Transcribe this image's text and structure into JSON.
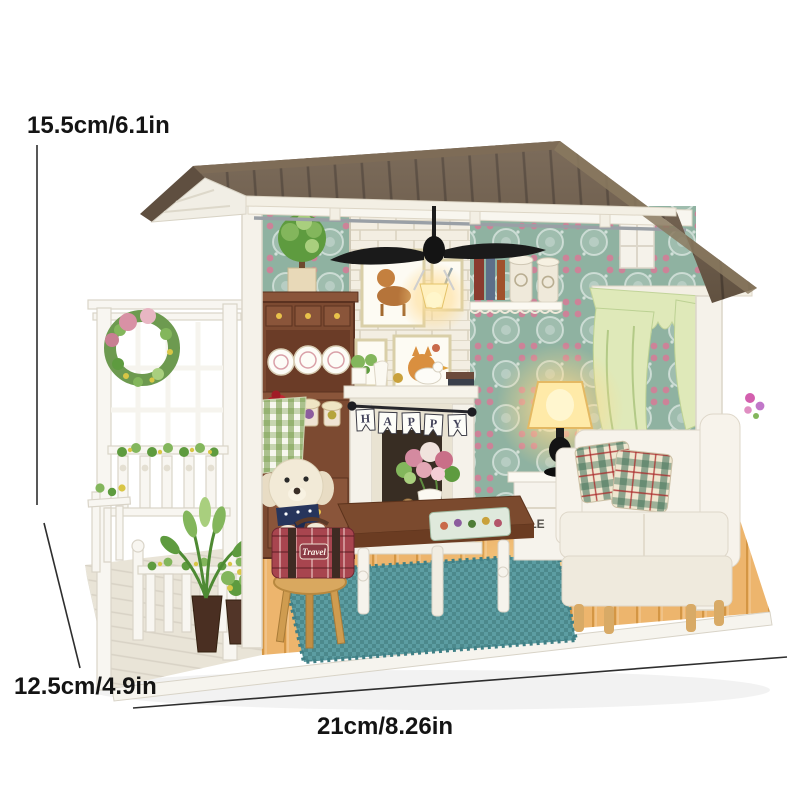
{
  "annotations": {
    "height_label": "15.5cm/6.1in",
    "depth_label": "12.5cm/4.9in",
    "width_label": "21cm/8.26in"
  },
  "scene_text": {
    "fireplace_banner_letters": [
      "H",
      "A",
      "P",
      "P",
      "Y"
    ],
    "suitcase_label": "Travel",
    "side_cabinet_label": "FLE"
  },
  "colors": {
    "background": "#ffffff",
    "roof_brown": "#6e5c49",
    "roof_shadow": "#55463a",
    "trim_cream": "#f3efe4",
    "wallpaper_teal": "#8fb2a1",
    "brick_white": "#f3eee2",
    "cabinet_brown": "#7c4a31",
    "floor_honey": "#edb56d",
    "porch_whitewash": "#e9e4d7",
    "rug_teal": "#5c9da2",
    "curtain_green": "#dfe9b9",
    "sofa_cream": "#f7f3eb",
    "lamp_glow": "#ffd98a",
    "suitcase_red": "#a8454f",
    "stool_tan": "#d9a85f",
    "dog_cream": "#f2ead7",
    "annotation_ink": "#141414"
  }
}
